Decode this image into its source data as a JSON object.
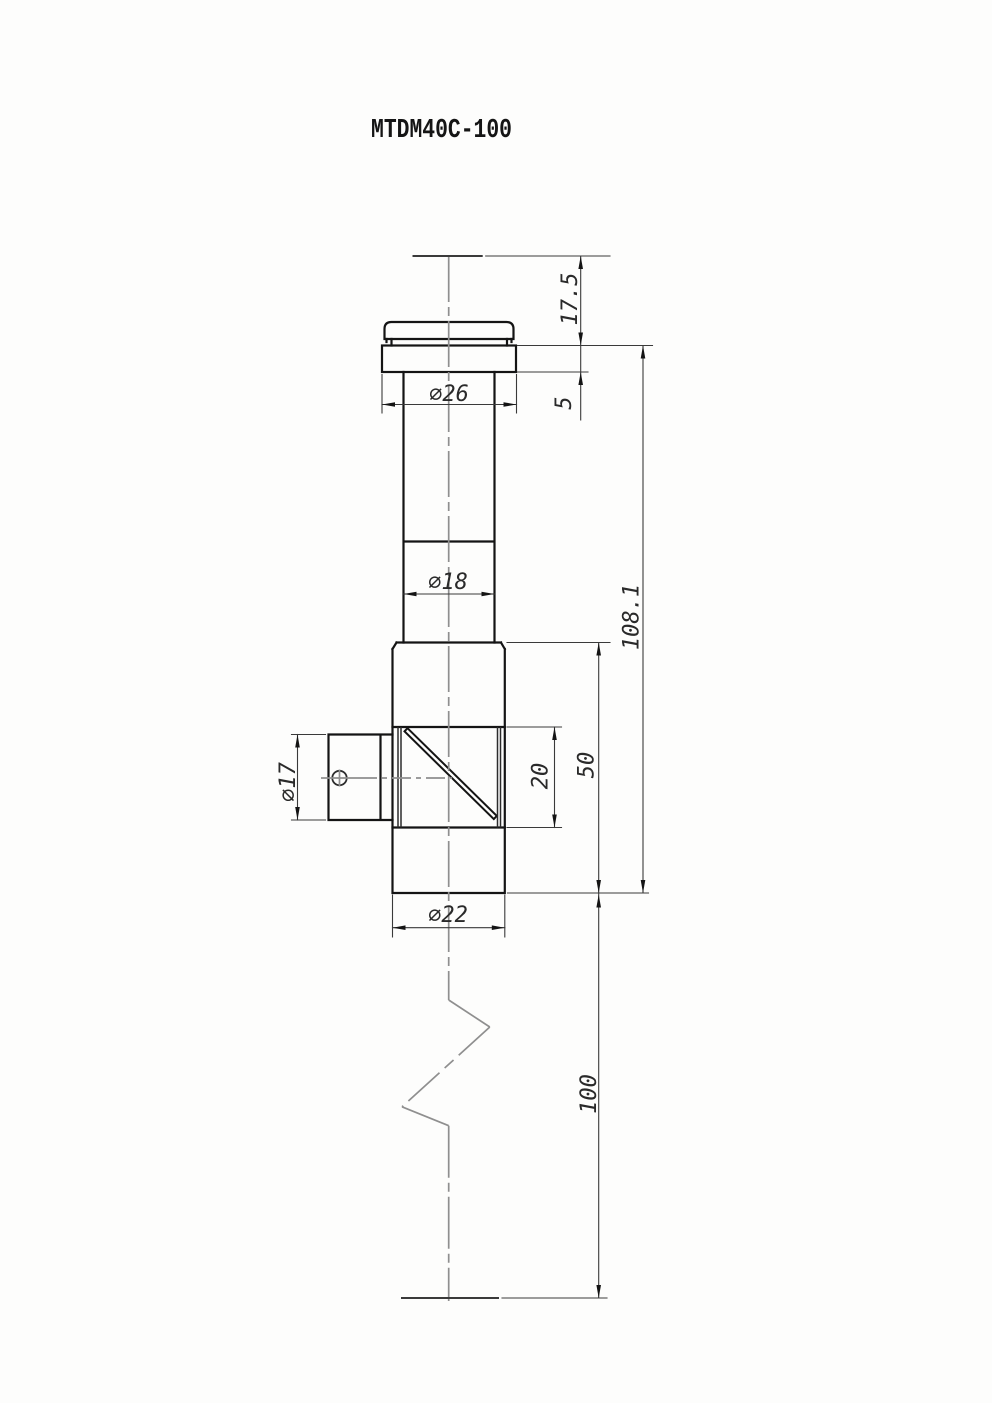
{
  "title": "MTDM40C-100",
  "dimensions": {
    "top_height": "17.5",
    "flange_thickness": "5",
    "flange_diameter": "∅26",
    "tube_diameter": "∅18",
    "port_diameter": "∅17",
    "window_height": "20",
    "body_height": "50",
    "overall_height": "108.1",
    "working_distance": "100",
    "body_diameter": "∅22"
  },
  "colors": {
    "outline": "#141414",
    "dimension": "#3a3a3a",
    "centerline": "#8f8f8f",
    "arrow": "#141414",
    "background": "#fdfdfc"
  }
}
